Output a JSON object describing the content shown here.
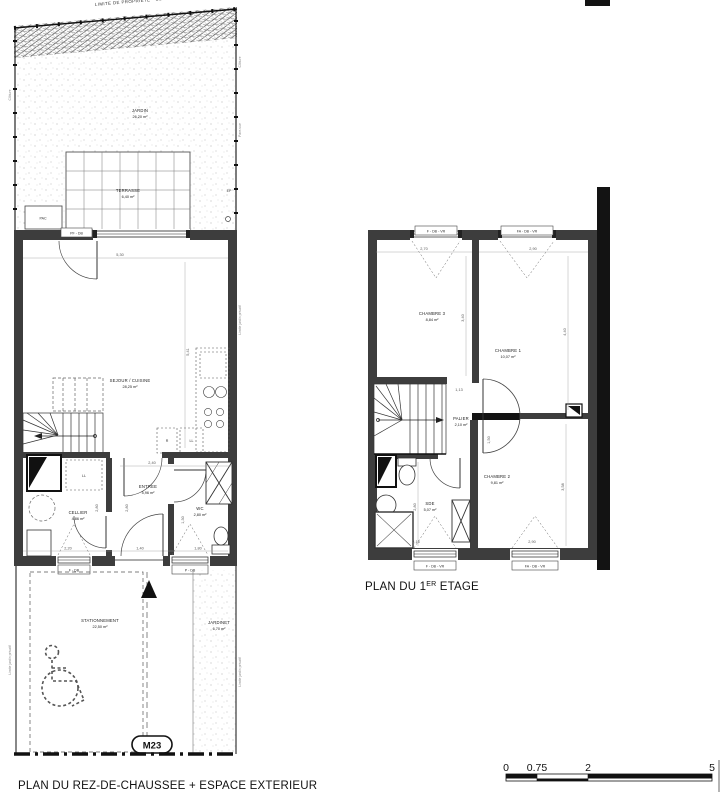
{
  "page": {
    "background": "#ffffff",
    "ink": "#111111",
    "wall_gray": "#3d3d3d",
    "dim_gray": "#555555"
  },
  "ground": {
    "caption": "PLAN DU REZ-DE-CHAUSSEE + ESPACE EXTERIEUR",
    "boundary_label": "LIMITE DE PROPRIETE - CLOTURE",
    "side_labels": {
      "cloture": "Clôture",
      "limite": "Limite jardin privatif",
      "pare_vue": "Pare-vue"
    },
    "rooms": {
      "jardin": {
        "name": "JARDIN",
        "area": "26,20 m²"
      },
      "terrasse": {
        "name": "TERRASSE",
        "area": "6,40 m²"
      },
      "sejour": {
        "name": "SEJOUR / CUISINE",
        "area": "28,25 m²"
      },
      "cellier": {
        "name": "CELLIER",
        "area": "4,86 m²"
      },
      "entree": {
        "name": "ENTREE",
        "area": "5,96 m²"
      },
      "wc": {
        "name": "WC",
        "area": "2,80 m²"
      },
      "stationnement": {
        "name": "STATIONNEMENT",
        "area": "22,50 m²"
      },
      "jardinet": {
        "name": "JARDINET",
        "area": "6,70 m²"
      }
    },
    "equipment": {
      "pac": "PAC",
      "ll": "LL",
      "r": "R",
      "ep": "EP"
    },
    "openings": {
      "top_window": "PF - DB",
      "bottom_left_window": "F - DB",
      "bottom_right_window": "P - DB"
    },
    "badge": "M23",
    "dims": {
      "sejour_w": "5,30",
      "sejour_h": "5,41",
      "entree_w": "2,40",
      "cellier_h": "2,80",
      "entree_h": "2,80",
      "wc_h": "1,30",
      "cellier_w": "2,20",
      "door_w": "1,40",
      "wc_w": "1,80"
    }
  },
  "first": {
    "caption_prefix": "PLAN DU 1",
    "caption_sup": "ER",
    "caption_suffix": " ETAGE",
    "rooms": {
      "chambre1": {
        "name": "CHAMBRE 1",
        "area": "10,07 m²"
      },
      "chambre2": {
        "name": "CHAMBRE 2",
        "area": "9,81 m²"
      },
      "chambre3": {
        "name": "CHAMBRE 3",
        "area": "8,84 m²"
      },
      "palier": {
        "name": "PALIER",
        "area": "2,10 m²"
      },
      "sde": {
        "name": "SDE",
        "area": "5,07 m²"
      }
    },
    "openings": {
      "top_left": "F - DB - VR",
      "top_right": "FA - DB - VR",
      "bottom_left": "F - DB - VR",
      "bottom_right": "FA - DB - VR"
    },
    "dims": {
      "ch3_w": "2,70",
      "ch1_w": "2,90",
      "ch3_h": "3,40",
      "ch1_h": "4,40",
      "palier_w": "1,13",
      "palier_h": "1,50",
      "sde_h": "2,80",
      "ch2_h": "3,58",
      "sde_w": "2,16",
      "ch2_w": "2,90"
    }
  },
  "scalebar": {
    "ticks": [
      "0",
      "0.75",
      "2",
      "5"
    ]
  }
}
